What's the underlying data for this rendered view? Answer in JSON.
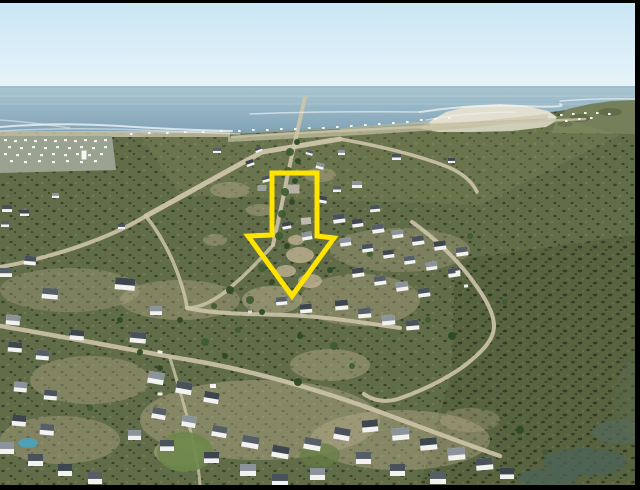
{
  "meta": {
    "description": "Aerial drone photograph of a coastal village: ocean horizon at top, white Cape-style houses with dark roofs, olive scrubland, sandy streets; a yellow outlined arrow highlights a vacant plot in the centre.",
    "width": 640,
    "height": 490
  },
  "frame": {
    "color": "#000000"
  },
  "palette": {
    "sky_top": "#c9e6f4",
    "sky_bottom": "#e9f4f9",
    "sea_top": "#a9c6d2",
    "sea_bottom": "#7d9fb3",
    "horizon": "#8fb0bf",
    "streak": "#c6d8de",
    "surf": "#f4f8f8",
    "beach_sand": "#e2ded0",
    "dune": "#cfc8af",
    "headland": "#75805a",
    "town_base": "#99a390",
    "coast_band": "#b7bba8",
    "field": "#616c48",
    "marsh": "#57623f",
    "sunlit": "#8e9865",
    "road": "#cdc4aa",
    "sand": "#bfb191",
    "speck": "#f4f5f2",
    "house_wall": "#f2f3f0",
    "tree_dark": "#2e4a27",
    "tree_light": "#3f5d31"
  },
  "annotation": {
    "name": "plot-highlight-arrow",
    "shape": "downward-arrow-outline",
    "color": "#ffe400",
    "stroke_width": 5,
    "points": "272,173 317,173 317,236 334,238 292,296 248,236 272,235"
  },
  "scene": {
    "roads": [
      [
        "M232,137 C300,132 380,129 440,126 C490,123 540,121 585,119",
        2.5,
        0.8
      ],
      [
        "M305,97 C300,120 293,150 287,178 C282,205 277,226 273,245",
        4,
        0.9
      ],
      [
        "M146,216 L262,152 L340,139",
        5,
        0.95
      ],
      [
        "M340,139 C380,146 420,156 448,167 C462,173 472,181 477,192",
        3.5,
        0.9
      ],
      [
        "M412,222 C432,236 456,258 472,280 C484,296 494,312 494,326 C494,340 482,352 464,366 C446,379 424,390 398,399 C384,403 372,400 364,394",
        4,
        0.9
      ],
      [
        "M146,216 C120,232 80,248 40,258 C26,262 12,265 0,267",
        4,
        0.9
      ],
      [
        "M146,216 C160,234 172,256 180,280 C184,292 186,300 187,308",
        3.5,
        0.85
      ],
      [
        "M187,308 C215,314 250,314 285,315 C320,316 360,322 400,328",
        4,
        0.9
      ],
      [
        "M0,326 C60,336 130,350 190,360 C250,370 320,390 380,412 C420,427 460,442 500,456",
        4.5,
        0.9
      ],
      [
        "M170,358 C180,390 190,424 196,456 C199,472 200,482 200,487",
        3,
        0.8
      ],
      [
        "M273,245 C260,260 246,274 230,288 C216,300 200,308 187,308",
        3.5,
        0.85
      ]
    ],
    "surf": [
      [
        "M0,127 Q60,122 120,126 T232,131",
        2,
        0.75
      ],
      [
        "M0,131 Q70,127 140,130 T240,134",
        1.5,
        0.5
      ],
      [
        "M250,114 Q320,111 420,112",
        1.5,
        0.6
      ],
      [
        "M420,112 Q470,104 520,106 T560,104",
        2,
        0.7
      ],
      [
        "M426,120 Q470,112 515,112",
        1.5,
        0.5
      ],
      [
        "M560,101 Q600,98 635,99",
        1.5,
        0.6
      ],
      [
        "M0,120 Q30,122 70,128",
        1.5,
        0.5
      ]
    ],
    "sand_patches": [
      [
        300,
        255,
        14,
        8,
        0.8
      ],
      [
        286,
        271,
        10,
        6,
        0.8
      ],
      [
        310,
        281,
        12,
        7,
        0.8
      ],
      [
        296,
        240,
        8,
        5,
        0.8
      ],
      [
        272,
        300,
        30,
        14,
        0.5
      ],
      [
        360,
        300,
        60,
        26,
        0.35
      ],
      [
        400,
        250,
        70,
        22,
        0.3
      ],
      [
        180,
        300,
        60,
        20,
        0.35
      ],
      [
        70,
        290,
        70,
        22,
        0.3
      ],
      [
        260,
        420,
        120,
        40,
        0.4
      ],
      [
        400,
        440,
        90,
        30,
        0.4
      ],
      [
        90,
        380,
        60,
        24,
        0.35
      ],
      [
        60,
        440,
        60,
        24,
        0.35
      ],
      [
        230,
        190,
        20,
        8,
        0.4
      ],
      [
        320,
        175,
        16,
        7,
        0.4
      ],
      [
        260,
        210,
        14,
        6,
        0.4
      ],
      [
        215,
        240,
        12,
        6,
        0.4
      ],
      [
        330,
        365,
        40,
        16,
        0.4
      ],
      [
        470,
        420,
        30,
        12,
        0.3
      ],
      [
        180,
        452,
        26,
        14,
        0.5
      ]
    ],
    "lawn_patches": [
      [
        185,
        452,
        28,
        20,
        "#6d8749",
        0.9
      ],
      [
        320,
        455,
        20,
        12,
        "#647e42",
        0.7
      ]
    ],
    "water_patches": [
      [
        28,
        443,
        10,
        5,
        "#4f9fb5",
        1
      ],
      [
        585,
        462,
        42,
        14,
        "#4e6358",
        0.8
      ],
      [
        620,
        432,
        28,
        12,
        "#54695c",
        0.7
      ],
      [
        548,
        478,
        30,
        9,
        "#4e6358",
        0.8
      ],
      [
        635,
        400,
        20,
        40,
        "#5a6b52",
        0.5
      ]
    ],
    "town_specks": [
      [
        4,
        139
      ],
      [
        14,
        140
      ],
      [
        24,
        139
      ],
      [
        34,
        140
      ],
      [
        44,
        139
      ],
      [
        54,
        140
      ],
      [
        64,
        139
      ],
      [
        74,
        140
      ],
      [
        84,
        139
      ],
      [
        94,
        140
      ],
      [
        104,
        139
      ],
      [
        8,
        146
      ],
      [
        20,
        147
      ],
      [
        32,
        146
      ],
      [
        44,
        147
      ],
      [
        56,
        146
      ],
      [
        68,
        147
      ],
      [
        80,
        146
      ],
      [
        92,
        147
      ],
      [
        104,
        146
      ],
      [
        4,
        153
      ],
      [
        16,
        154
      ],
      [
        28,
        153
      ],
      [
        40,
        154
      ],
      [
        52,
        153
      ],
      [
        64,
        154
      ],
      [
        76,
        153
      ],
      [
        88,
        154
      ],
      [
        100,
        153
      ],
      [
        10,
        160
      ],
      [
        24,
        161
      ],
      [
        38,
        160
      ],
      [
        52,
        161
      ],
      [
        66,
        160
      ],
      [
        80,
        161
      ],
      [
        94,
        160
      ]
    ],
    "coast_specks": [
      [
        130,
        133
      ],
      [
        148,
        132
      ],
      [
        166,
        132
      ],
      [
        184,
        131
      ],
      [
        202,
        131
      ],
      [
        220,
        130
      ],
      [
        238,
        130
      ],
      [
        252,
        129
      ],
      [
        266,
        129
      ],
      [
        280,
        128
      ],
      [
        294,
        128
      ],
      [
        308,
        127
      ],
      [
        322,
        127
      ],
      [
        336,
        126
      ],
      [
        350,
        125
      ],
      [
        364,
        124
      ],
      [
        378,
        123
      ],
      [
        392,
        122
      ],
      [
        406,
        121
      ],
      [
        420,
        119
      ],
      [
        434,
        118
      ],
      [
        448,
        117
      ],
      [
        560,
        114
      ],
      [
        572,
        113
      ],
      [
        584,
        112
      ],
      [
        596,
        112
      ],
      [
        608,
        113
      ],
      [
        565,
        120
      ],
      [
        578,
        118
      ],
      [
        590,
        117
      ]
    ],
    "gray_buildings": [
      [
        293,
        189,
        13,
        9,
        0,
        "#b6b1a4"
      ],
      [
        306,
        221,
        10,
        7,
        -5,
        "#c0bbae"
      ],
      [
        262,
        188,
        9,
        6,
        0,
        "#9aa39b"
      ],
      [
        84,
        155,
        5,
        9,
        0,
        "#f5f6f3"
      ]
    ],
    "houses": [
      [
        2,
        205,
        10,
        7,
        0
      ],
      [
        20,
        210,
        9,
        6,
        0
      ],
      [
        1,
        221,
        8,
        6,
        0
      ],
      [
        52,
        193,
        7,
        5,
        0
      ],
      [
        118,
        224,
        7,
        5,
        0
      ],
      [
        115,
        278,
        20,
        12,
        5
      ],
      [
        42,
        288,
        16,
        11,
        5
      ],
      [
        6,
        315,
        14,
        10,
        5
      ],
      [
        130,
        332,
        16,
        11,
        5
      ],
      [
        70,
        330,
        14,
        10,
        5
      ],
      [
        0,
        268,
        12,
        9,
        0
      ],
      [
        150,
        306,
        12,
        9,
        0
      ],
      [
        24,
        256,
        12,
        9,
        5
      ],
      [
        8,
        342,
        14,
        10,
        5
      ],
      [
        36,
        350,
        13,
        10,
        5
      ],
      [
        14,
        382,
        13,
        10,
        5
      ],
      [
        44,
        390,
        13,
        10,
        5
      ],
      [
        12,
        415,
        14,
        11,
        5
      ],
      [
        40,
        424,
        14,
        11,
        5
      ],
      [
        0,
        442,
        14,
        12,
        0
      ],
      [
        28,
        454,
        15,
        12,
        0
      ],
      [
        58,
        464,
        14,
        12,
        0
      ],
      [
        88,
        472,
        14,
        12,
        0
      ],
      [
        148,
        372,
        16,
        12,
        10
      ],
      [
        176,
        382,
        16,
        12,
        10
      ],
      [
        204,
        392,
        15,
        11,
        10
      ],
      [
        152,
        408,
        14,
        11,
        10
      ],
      [
        128,
        430,
        13,
        10,
        0
      ],
      [
        160,
        440,
        14,
        11,
        0
      ],
      [
        204,
        452,
        15,
        11,
        0
      ],
      [
        242,
        436,
        17,
        12,
        10
      ],
      [
        240,
        464,
        16,
        12,
        0
      ],
      [
        272,
        474,
        16,
        12,
        0
      ],
      [
        272,
        446,
        17,
        12,
        10
      ],
      [
        304,
        438,
        17,
        12,
        10
      ],
      [
        310,
        468,
        15,
        12,
        0
      ],
      [
        334,
        428,
        16,
        12,
        10
      ],
      [
        362,
        420,
        16,
        12,
        -5
      ],
      [
        356,
        452,
        15,
        12,
        0
      ],
      [
        392,
        428,
        17,
        12,
        -5
      ],
      [
        390,
        464,
        15,
        12,
        0
      ],
      [
        420,
        438,
        17,
        12,
        -5
      ],
      [
        430,
        472,
        16,
        12,
        0
      ],
      [
        448,
        448,
        17,
        12,
        -5
      ],
      [
        476,
        458,
        17,
        12,
        -5
      ],
      [
        500,
        468,
        14,
        11,
        0
      ],
      [
        212,
        426,
        15,
        11,
        10
      ],
      [
        182,
        416,
        14,
        11,
        10
      ],
      [
        333,
        214,
        12,
        9,
        -8
      ],
      [
        352,
        219,
        11,
        8,
        -8
      ],
      [
        372,
        224,
        12,
        9,
        -8
      ],
      [
        392,
        230,
        11,
        8,
        -8
      ],
      [
        412,
        236,
        12,
        9,
        -8
      ],
      [
        434,
        241,
        12,
        9,
        -8
      ],
      [
        456,
        247,
        12,
        9,
        -8
      ],
      [
        340,
        238,
        11,
        8,
        -8
      ],
      [
        362,
        244,
        11,
        8,
        -8
      ],
      [
        383,
        250,
        11,
        8,
        -8
      ],
      [
        404,
        256,
        11,
        8,
        -8
      ],
      [
        426,
        262,
        11,
        8,
        -8
      ],
      [
        448,
        268,
        12,
        9,
        -8
      ],
      [
        352,
        268,
        12,
        9,
        -8
      ],
      [
        374,
        276,
        12,
        9,
        -8
      ],
      [
        396,
        282,
        12,
        9,
        -8
      ],
      [
        418,
        288,
        12,
        9,
        -8
      ],
      [
        335,
        300,
        13,
        10,
        -5
      ],
      [
        358,
        308,
        13,
        10,
        -5
      ],
      [
        382,
        315,
        13,
        10,
        -5
      ],
      [
        406,
        320,
        13,
        10,
        -5
      ],
      [
        300,
        304,
        12,
        9,
        -5
      ],
      [
        276,
        297,
        11,
        8,
        -5
      ],
      [
        302,
        232,
        10,
        8,
        -10
      ],
      [
        255,
        147,
        7,
        5,
        -20
      ],
      [
        246,
        160,
        8,
        6,
        -20
      ],
      [
        306,
        150,
        7,
        5,
        15
      ],
      [
        316,
        163,
        8,
        6,
        15
      ],
      [
        262,
        176,
        8,
        6,
        -15
      ],
      [
        318,
        196,
        9,
        7,
        10
      ],
      [
        333,
        186,
        8,
        6,
        0
      ],
      [
        352,
        181,
        10,
        7,
        0
      ],
      [
        370,
        205,
        10,
        7,
        -5
      ],
      [
        282,
        222,
        9,
        7,
        -10
      ],
      [
        213,
        148,
        8,
        5,
        0
      ],
      [
        338,
        150,
        7,
        5,
        0
      ],
      [
        392,
        154,
        9,
        6,
        0
      ],
      [
        448,
        158,
        7,
        5,
        0
      ]
    ],
    "trees": [
      [
        297,
        142,
        3
      ],
      [
        290,
        152,
        4
      ],
      [
        298,
        161,
        3
      ],
      [
        288,
        171,
        4
      ],
      [
        295,
        181,
        3
      ],
      [
        285,
        192,
        4
      ],
      [
        292,
        202,
        3
      ],
      [
        282,
        214,
        4
      ],
      [
        289,
        224,
        3
      ],
      [
        279,
        236,
        4
      ],
      [
        287,
        246,
        3
      ],
      [
        250,
        300,
        4
      ],
      [
        262,
        312,
        3
      ],
      [
        238,
        330,
        3
      ],
      [
        180,
        320,
        3
      ],
      [
        205,
        342,
        4
      ],
      [
        225,
        356,
        3
      ],
      [
        334,
        346,
        4
      ],
      [
        300,
        336,
        3
      ],
      [
        428,
        320,
        3
      ],
      [
        452,
        336,
        4
      ],
      [
        352,
        366,
        3
      ],
      [
        298,
        382,
        4
      ],
      [
        505,
        302,
        3
      ],
      [
        520,
        430,
        4
      ],
      [
        545,
        452,
        3
      ],
      [
        120,
        320,
        3
      ],
      [
        72,
        334,
        3
      ],
      [
        160,
        368,
        3
      ],
      [
        90,
        408,
        3
      ],
      [
        140,
        352,
        3
      ],
      [
        262,
        268,
        4
      ],
      [
        272,
        282,
        3
      ],
      [
        370,
        254,
        3
      ],
      [
        330,
        270,
        3
      ],
      [
        470,
        236,
        3
      ],
      [
        230,
        290,
        4
      ],
      [
        214,
        306,
        3
      ]
    ],
    "vehicles": [
      [
        458,
        272,
        5,
        3,
        -8,
        "#f2f2f0"
      ],
      [
        466,
        286,
        4,
        3,
        -8,
        "#eeeeec"
      ],
      [
        160,
        352,
        5,
        3,
        10,
        "#f0f0ee"
      ],
      [
        250,
        312,
        4,
        3,
        0,
        "#dcdcda"
      ],
      [
        213,
        386,
        6,
        4,
        0,
        "#f4f4f2"
      ],
      [
        160,
        394,
        5,
        3,
        0,
        "#efefec"
      ]
    ]
  }
}
